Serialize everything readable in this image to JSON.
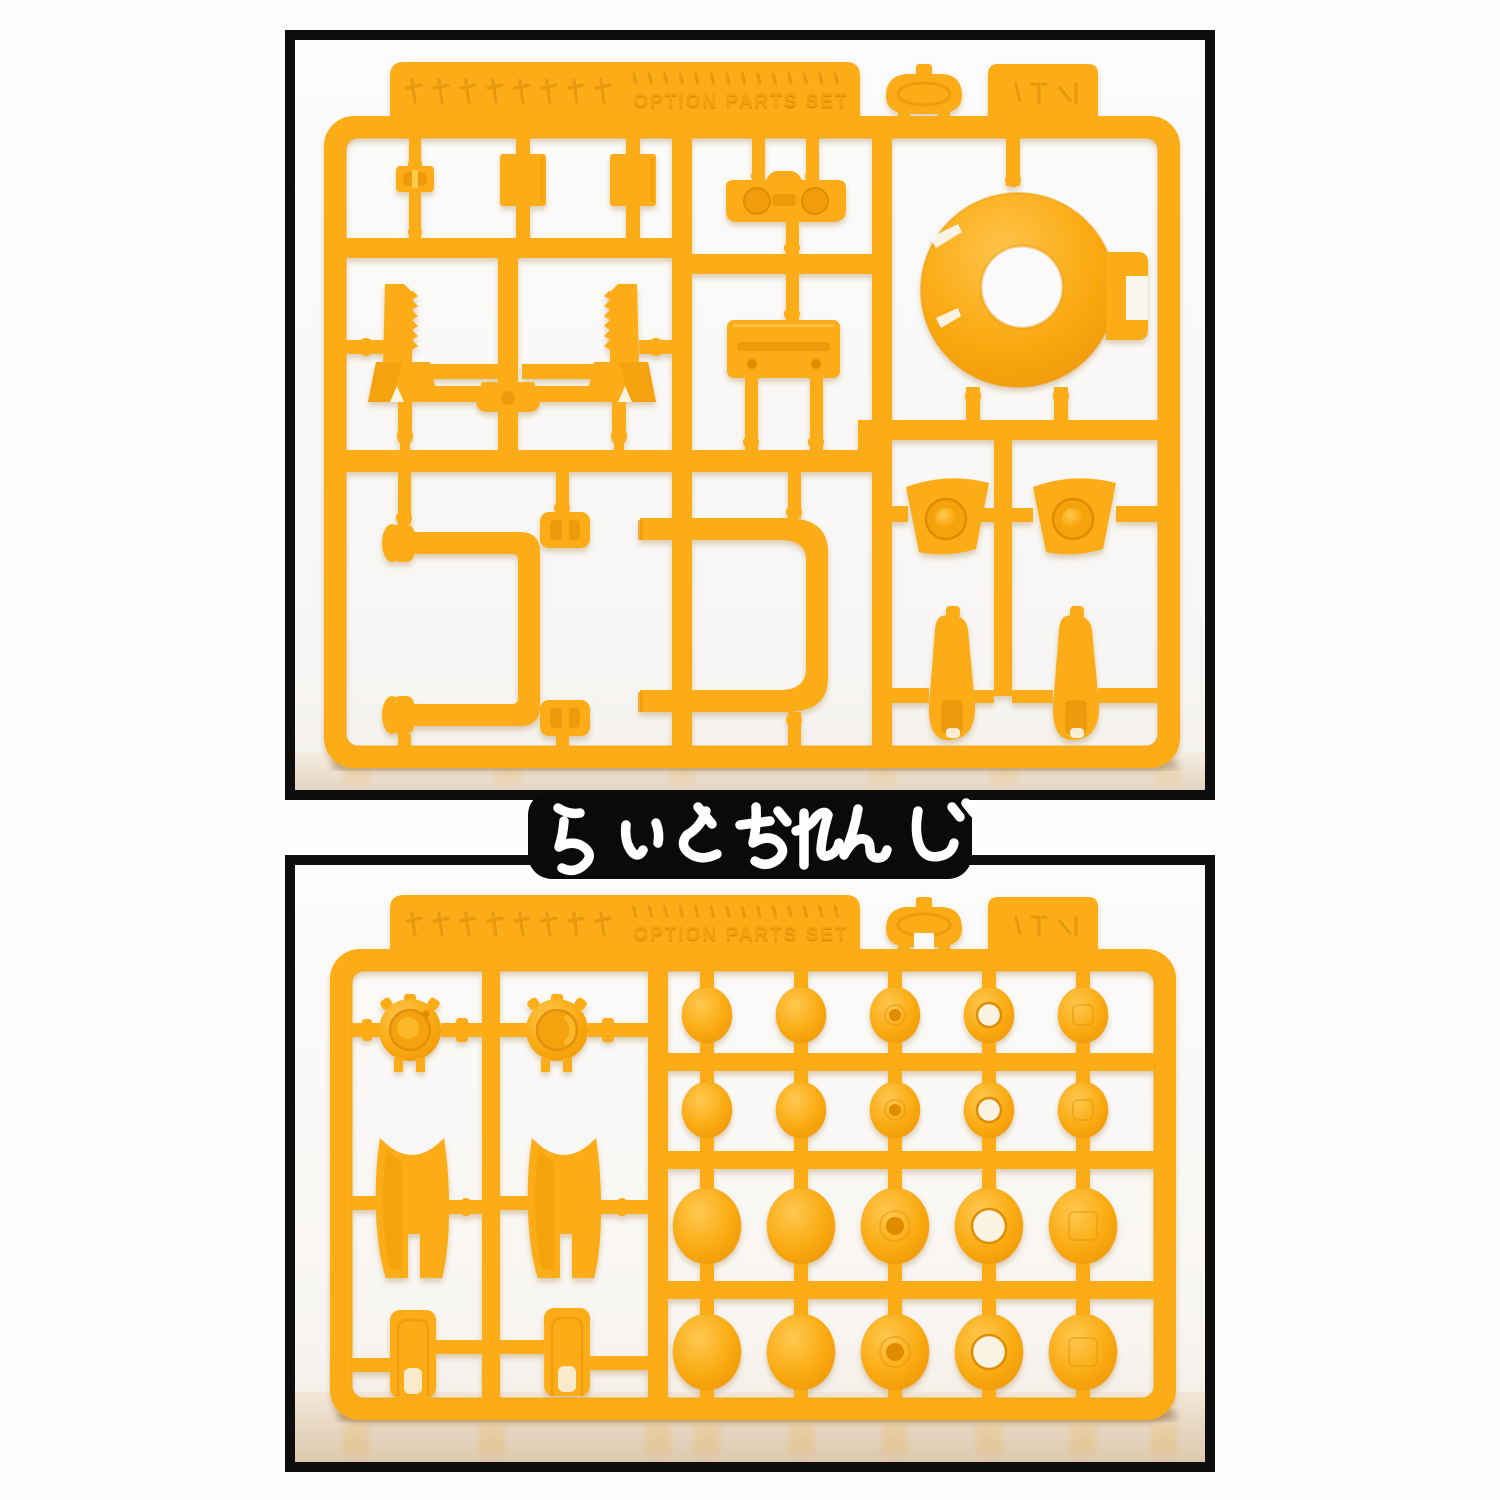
{
  "product_label": {
    "text": "らいとおれんじ",
    "background": "#0a0a0a",
    "text_color": "#ffffff"
  },
  "colors": {
    "plastic_base": "#FBAC15",
    "plastic_shadow": "#EE9A09",
    "plastic_deep": "#E08C06",
    "plastic_highlight": "#FFC94E",
    "photo_background": "#FBFAF8",
    "floor_warm": "#DECDB9",
    "frame_border": "#0e0e0e"
  },
  "runner_a": {
    "description": "injection-molded plastic runner A, light orange, option parts",
    "embossed_text": "OPTION PARTS SET",
    "parts": [
      "ring-collar",
      "visor-goggle",
      "back-plate",
      "saw-antenna x2",
      "square-plate x2",
      "slot-clip",
      "c-shaped-pipe",
      "rectangular-pipe",
      "shoulder-guard x2",
      "boot x2"
    ]
  },
  "runner_b": {
    "description": "injection-molded plastic runner B, light orange, sphere parts",
    "embossed_text": "OPTION PARTS SET",
    "parts": [
      "spiked-disc x2",
      "shell-cover x2",
      "cylinder-clip x2",
      "sphere-bead x20"
    ],
    "ball_grid": {
      "columns_x": [
        707,
        801,
        895,
        989,
        1083
      ],
      "rows": [
        {
          "y": 1015,
          "rx": 25,
          "ry": 28
        },
        {
          "y": 1110,
          "rx": 25,
          "ry": 28
        },
        {
          "y": 1226,
          "rx": 34,
          "ry": 38
        },
        {
          "y": 1352,
          "rx": 34,
          "ry": 38
        }
      ],
      "column_details": [
        "plain",
        "plain",
        "dimple",
        "socket",
        "inset"
      ]
    }
  }
}
